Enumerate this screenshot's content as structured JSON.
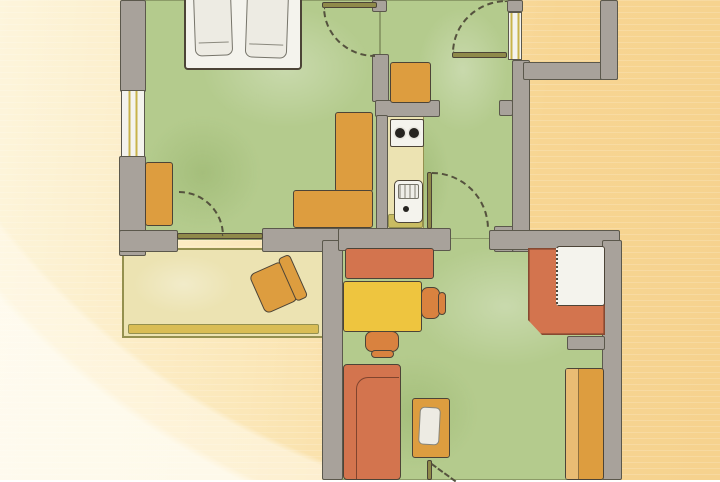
{
  "artwork": {
    "kind": "watercolor floor plan illustration",
    "text_content": "none"
  },
  "palette": {
    "bg1": "#fdf5dc",
    "bg2": "#fbe7b8",
    "bg3": "#f7d592",
    "bg4": "#f6d28e",
    "wall": "#a8a29b",
    "wallEdge": "#5b584c",
    "ink": "#55523e",
    "inkDark": "#4c4437",
    "green": "#b4cb8d",
    "cream": "#ece3b2",
    "creamEdge": "#94904f",
    "balconyStrip": "#d9bd55",
    "oliveSoft": "#c9bc62",
    "olive": "#8f8a4a",
    "windowY": "#c8b34a",
    "orange": "#dd9d3f",
    "orangeDeep": "#d9823f",
    "terra": "#d3744e",
    "yellow": "#eec53f",
    "white": "#f4f3ed",
    "whiteSoft": "#edebe3",
    "burner": "#262420"
  },
  "plan": {
    "shapes": [
      {
        "name": "bedroom-floor",
        "cls": "floor green",
        "x": 133,
        "y": 0,
        "w": 247,
        "h": 240,
        "z": 1
      },
      {
        "name": "hallway-floor",
        "cls": "floor green",
        "x": 380,
        "y": 0,
        "w": 134,
        "h": 248,
        "z": 1
      },
      {
        "name": "living-room-floor",
        "cls": "floor green",
        "x": 338,
        "y": 238,
        "w": 270,
        "h": 242,
        "z": 1
      },
      {
        "name": "balcony-floor",
        "cls": "balcony",
        "x": 122,
        "y": 248,
        "w": 203,
        "h": 90,
        "z": 1
      },
      {
        "name": "kitchen-counter",
        "cls": "counter",
        "x": 387,
        "y": 116,
        "w": 37,
        "h": 114,
        "z": 2
      },
      {
        "name": "kitchen-counter-end",
        "cls": "shelf",
        "x": 388,
        "y": 214,
        "w": 35,
        "h": 14,
        "z": 2
      },
      {
        "name": "wall-left-top",
        "cls": "wall",
        "x": 120,
        "y": 0,
        "w": 26,
        "h": 92,
        "z": 3
      },
      {
        "name": "bedroom-window",
        "cls": "window-v",
        "x": 121,
        "y": 90,
        "w": 24,
        "h": 68,
        "z": 3
      },
      {
        "name": "wall-left-mid",
        "cls": "wall",
        "x": 119,
        "y": 156,
        "w": 27,
        "h": 100,
        "z": 3
      },
      {
        "name": "wall-bedroom-bottom",
        "cls": "wall",
        "x": 119,
        "y": 230,
        "w": 59,
        "h": 22,
        "z": 3
      },
      {
        "name": "wall-mid-bottom",
        "cls": "wall",
        "x": 262,
        "y": 228,
        "w": 81,
        "h": 24,
        "z": 3
      },
      {
        "name": "wall-living-left",
        "cls": "wall",
        "x": 322,
        "y": 240,
        "w": 21,
        "h": 240,
        "z": 3
      },
      {
        "name": "wall-divider-top",
        "cls": "wall",
        "x": 372,
        "y": 54,
        "w": 17,
        "h": 48,
        "z": 3
      },
      {
        "name": "wall-kitchen-top",
        "cls": "wall",
        "x": 375,
        "y": 100,
        "w": 65,
        "h": 17,
        "z": 3
      },
      {
        "name": "wall-kitchen-divider",
        "cls": "wall",
        "x": 376,
        "y": 115,
        "w": 12,
        "h": 123,
        "z": 3
      },
      {
        "name": "wall-hall-bottom",
        "cls": "wall",
        "x": 338,
        "y": 228,
        "w": 113,
        "h": 23,
        "z": 3
      },
      {
        "name": "wall-hall-corner",
        "cls": "wall",
        "x": 494,
        "y": 226,
        "w": 36,
        "h": 26,
        "z": 3
      },
      {
        "name": "wall-hall-right",
        "cls": "wall",
        "x": 512,
        "y": 60,
        "w": 18,
        "h": 192,
        "z": 3
      },
      {
        "name": "door-jamb-hall",
        "cls": "wall",
        "x": 499,
        "y": 100,
        "w": 14,
        "h": 16,
        "z": 3
      },
      {
        "name": "wall-exterior-horizontal",
        "cls": "wall",
        "x": 523,
        "y": 62,
        "w": 95,
        "h": 18,
        "z": 3
      },
      {
        "name": "wall-exterior-vertical",
        "cls": "wall",
        "x": 600,
        "y": 0,
        "w": 18,
        "h": 80,
        "z": 3
      },
      {
        "name": "wall-nook-top",
        "cls": "wall",
        "x": 489,
        "y": 230,
        "w": 131,
        "h": 20,
        "z": 3
      },
      {
        "name": "wall-living-right",
        "cls": "wall",
        "x": 602,
        "y": 240,
        "w": 20,
        "h": 240,
        "z": 3
      },
      {
        "name": "wall-stub-bedroom-door",
        "cls": "wall",
        "x": 372,
        "y": 0,
        "w": 15,
        "h": 12,
        "z": 3
      },
      {
        "name": "wall-stub-nook",
        "cls": "wall",
        "x": 567,
        "y": 336,
        "w": 38,
        "h": 14,
        "z": 3
      },
      {
        "name": "wall-stub-top-right",
        "cls": "wall",
        "x": 507,
        "y": 0,
        "w": 16,
        "h": 12,
        "z": 3
      },
      {
        "name": "hall-window",
        "cls": "window-v",
        "x": 508,
        "y": 12,
        "w": 14,
        "h": 48,
        "z": 3
      },
      {
        "name": "double-bed-frame",
        "cls": "bed",
        "x": 184,
        "y": -20,
        "w": 118,
        "h": 90,
        "z": 4
      },
      {
        "name": "mattress-left",
        "cls": "mattress",
        "x": 194,
        "y": -12,
        "w": 38,
        "h": 68,
        "rot": -2,
        "z": 4
      },
      {
        "name": "mattress-right",
        "cls": "mattress",
        "x": 246,
        "y": -14,
        "w": 42,
        "h": 72,
        "rot": 2,
        "z": 4
      },
      {
        "name": "bedroom-wardrobe",
        "cls": "furn",
        "fill": "orange",
        "x": 145,
        "y": 162,
        "w": 28,
        "h": 64,
        "z": 4
      },
      {
        "name": "bedroom-desk-long",
        "cls": "furn",
        "fill": "orange",
        "x": 335,
        "y": 112,
        "w": 38,
        "h": 80,
        "z": 4
      },
      {
        "name": "bedroom-desk-short",
        "cls": "furn",
        "fill": "orange",
        "x": 293,
        "y": 190,
        "w": 80,
        "h": 38,
        "z": 4
      },
      {
        "name": "kitchen-cabinet",
        "cls": "furn",
        "fill": "orange",
        "x": 390,
        "y": 62,
        "w": 41,
        "h": 41,
        "z": 4
      },
      {
        "name": "stove",
        "cls": "stove",
        "x": 390,
        "y": 119,
        "w": 34,
        "h": 28,
        "z": 4
      },
      {
        "name": "sink",
        "cls": "sink",
        "x": 394,
        "y": 180,
        "w": 29,
        "h": 43,
        "z": 4
      },
      {
        "name": "balcony-chair",
        "cls": "balcony-chair",
        "x": 255,
        "y": 261,
        "w": 46,
        "h": 48,
        "rot": -24,
        "z": 4
      },
      {
        "name": "sideboard",
        "cls": "furn",
        "fill": "terra",
        "x": 345,
        "y": 248,
        "w": 89,
        "h": 31,
        "z": 4
      },
      {
        "name": "desk",
        "cls": "furn",
        "fill": "yellow",
        "x": 343,
        "y": 281,
        "w": 79,
        "h": 51,
        "z": 4
      },
      {
        "name": "desk-chair-seat",
        "cls": "furn chair",
        "fill": "orangeDeep",
        "x": 421,
        "y": 287,
        "w": 19,
        "h": 32,
        "z": 4
      },
      {
        "name": "desk-chair-back",
        "cls": "furn chair",
        "fill": "orangeDeep",
        "x": 438,
        "y": 292,
        "w": 8,
        "h": 23,
        "z": 4
      },
      {
        "name": "front-chair-seat",
        "cls": "furn chair",
        "fill": "orangeDeep",
        "x": 365,
        "y": 331,
        "w": 34,
        "h": 21,
        "z": 4
      },
      {
        "name": "front-chair-back",
        "cls": "furn chair",
        "fill": "orangeDeep",
        "x": 371,
        "y": 350,
        "w": 23,
        "h": 8,
        "z": 4
      },
      {
        "name": "corner-bench",
        "cls": "bench",
        "x": 528,
        "y": 248,
        "w": 77,
        "h": 87,
        "z": 4
      },
      {
        "name": "dining-table",
        "cls": "table-dashed",
        "x": 556,
        "y": 246,
        "w": 49,
        "h": 60,
        "z": 5
      },
      {
        "name": "living-wardrobe",
        "cls": "furn wardrobe",
        "fill": "orange",
        "x": 565,
        "y": 368,
        "w": 39,
        "h": 112,
        "z": 4
      },
      {
        "name": "sofa",
        "cls": "sofa",
        "x": 343,
        "y": 364,
        "w": 58,
        "h": 116,
        "z": 4
      },
      {
        "name": "coffee-table",
        "cls": "furn",
        "fill": "orange",
        "x": 412,
        "y": 398,
        "w": 38,
        "h": 60,
        "z": 4
      },
      {
        "name": "magazine",
        "cls": "paper",
        "x": 419,
        "y": 407,
        "w": 21,
        "h": 38,
        "rot": 3,
        "z": 5
      },
      {
        "name": "balcony-door-leaf",
        "cls": "door-leaf",
        "fill": "olive",
        "x": 177,
        "y": 233,
        "w": 86,
        "h": 6,
        "z": 5
      },
      {
        "name": "bedroom-door-leaf",
        "cls": "door-leaf",
        "fill": "olive",
        "x": 322,
        "y": 2,
        "w": 55,
        "h": 6,
        "z": 5
      },
      {
        "name": "toproom-door-leaf",
        "cls": "door-leaf",
        "fill": "olive",
        "x": 452,
        "y": 52,
        "w": 55,
        "h": 6,
        "z": 5
      },
      {
        "name": "hall-door-leaf",
        "cls": "door-leaf",
        "fill": "olive",
        "x": 427,
        "y": 172,
        "w": 5,
        "h": 57,
        "z": 5
      },
      {
        "name": "bottom-door-leaf",
        "cls": "door-leaf",
        "fill": "olive",
        "x": 427,
        "y": 460,
        "w": 5,
        "h": 20,
        "z": 5
      },
      {
        "name": "bedroom-door-arc",
        "cls": "arc arc-bl",
        "x": 323,
        "y": 7,
        "w": 52,
        "h": 50,
        "z": 5
      },
      {
        "name": "toproom-door-arc",
        "cls": "arc arc-tl",
        "x": 452,
        "y": 0,
        "w": 55,
        "h": 53,
        "z": 5
      },
      {
        "name": "hall-door-arc",
        "cls": "arc arc-tr",
        "x": 432,
        "y": 172,
        "w": 57,
        "h": 57,
        "z": 5
      },
      {
        "name": "balcony-door-arc",
        "cls": "arc arc-tr",
        "x": 179,
        "y": 191,
        "w": 45,
        "h": 45,
        "z": 5
      },
      {
        "name": "bottom-door-swing",
        "cls": "swing-line",
        "x": 432,
        "y": 463,
        "w": 30,
        "h": 2,
        "rot": 36,
        "z": 5
      }
    ]
  }
}
